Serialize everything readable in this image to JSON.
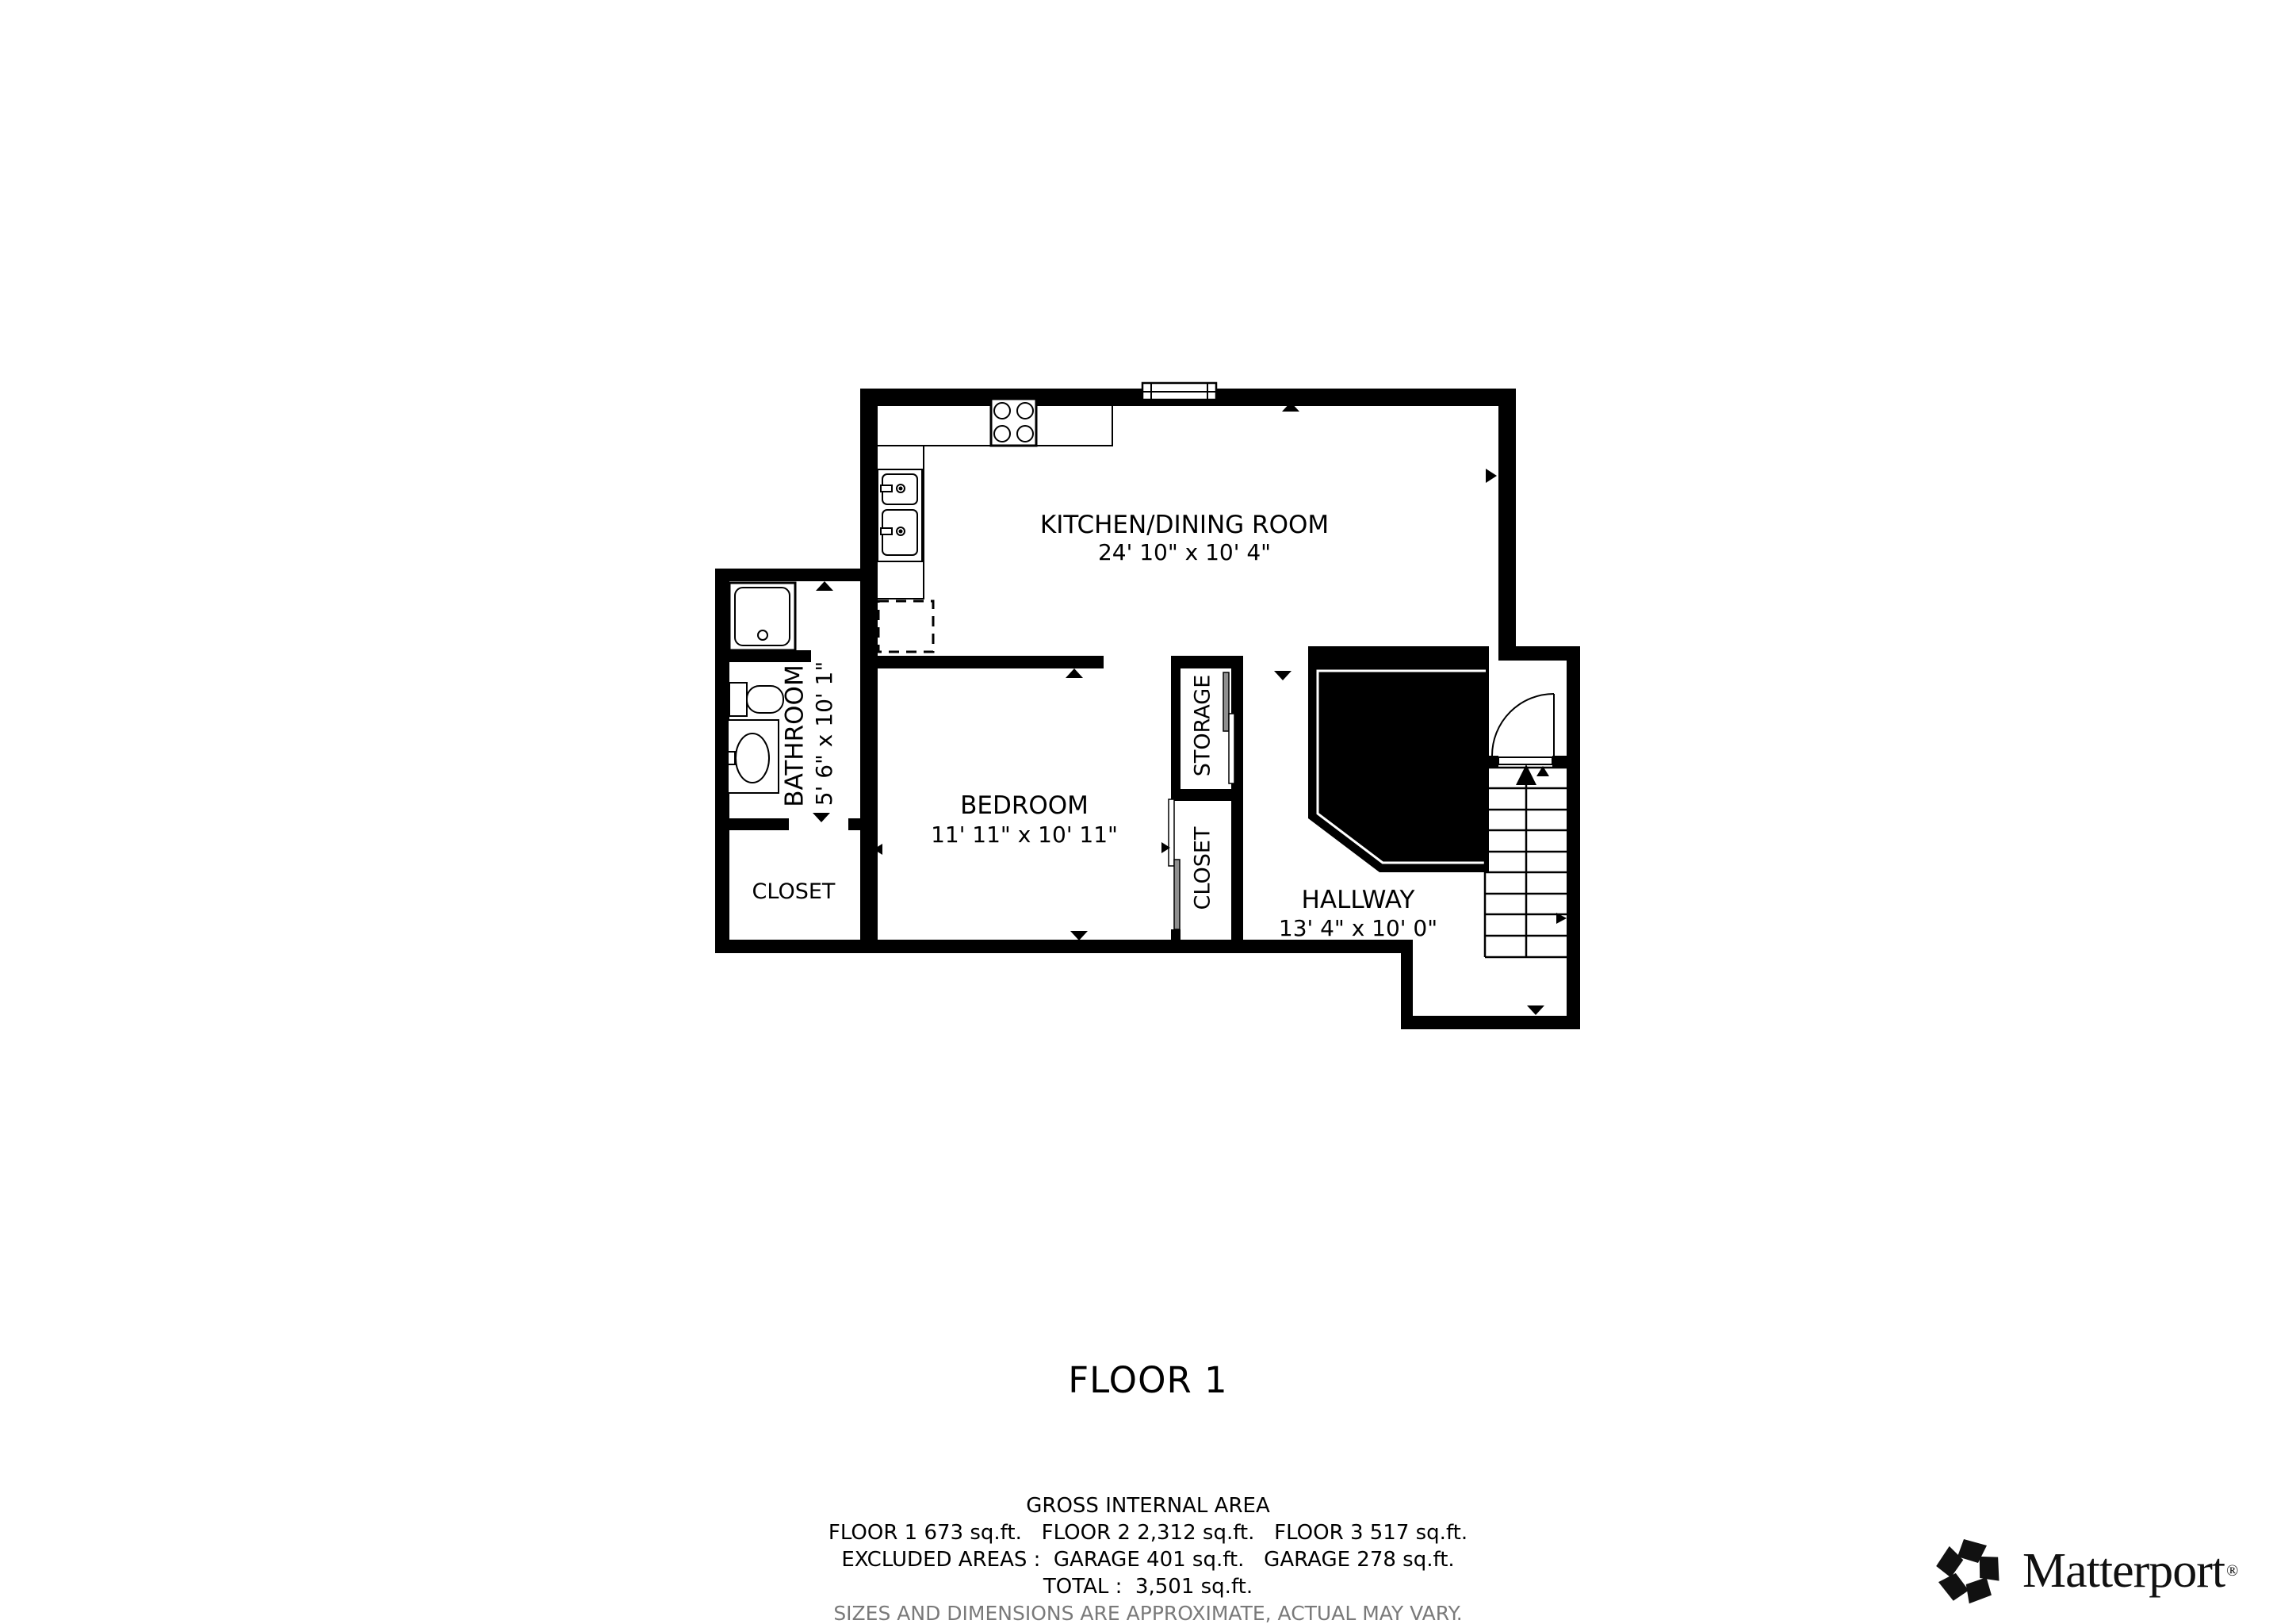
{
  "floor_plan": {
    "title": "FLOOR 1",
    "rooms": [
      {
        "id": "kitchen",
        "name": "KITCHEN/DINING ROOM",
        "dimensions": "24' 10\" x 10' 4\""
      },
      {
        "id": "bedroom",
        "name": "BEDROOM",
        "dimensions": "11' 11\" x 10' 11\""
      },
      {
        "id": "bathroom",
        "name": "BATHROOM",
        "dimensions": "5' 6\" x 10' 1\""
      },
      {
        "id": "hallway",
        "name": "HALLWAY",
        "dimensions": "13' 4\" x 10' 0\""
      },
      {
        "id": "closet-bathroom",
        "name": "CLOSET"
      },
      {
        "id": "storage",
        "name": "STORAGE"
      },
      {
        "id": "closet-bedroom",
        "name": "CLOSET"
      }
    ]
  },
  "footer": {
    "heading": "GROSS INTERNAL AREA",
    "floors_line": "FLOOR 1 673 sq.ft.   FLOOR 2 2,312 sq.ft.   FLOOR 3 517 sq.ft.",
    "excluded_line": "EXCLUDED AREAS :  GARAGE 401 sq.ft.   GARAGE 278 sq.ft.",
    "total_line": "TOTAL :  3,501 sq.ft.",
    "disclaimer": "SIZES AND DIMENSIONS ARE APPROXIMATE, ACTUAL MAY VARY."
  },
  "branding": {
    "wordmark": "Matterport",
    "registered": "®"
  },
  "colors": {
    "walls": "#000000",
    "background": "#ffffff",
    "disclaimer_text": "#7a7a7a",
    "sliding_panel_gray": "#8f8f8f"
  }
}
